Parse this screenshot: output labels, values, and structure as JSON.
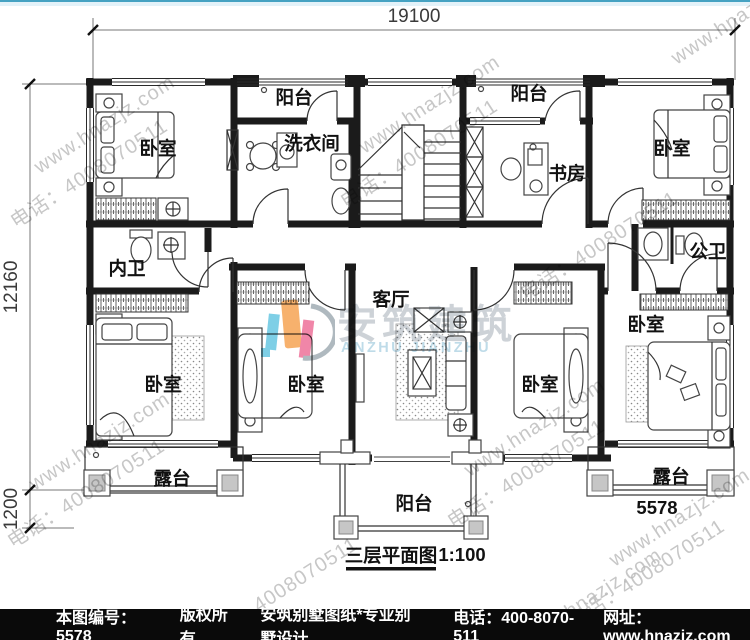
{
  "dimensions": {
    "width_total": "19100",
    "height_total": "12160",
    "terrace_offset": "1200"
  },
  "rooms": {
    "bedroom": "卧室",
    "balcony": "阳台",
    "laundry": "洗衣间",
    "study": "书房",
    "inner_bath": "内卫",
    "public_bath": "公卫",
    "living_room": "客厅",
    "terrace": "露台"
  },
  "plan": {
    "number": "5578",
    "title": "三层平面图",
    "scale": "1:100"
  },
  "watermark": {
    "site": "www.hnazjz.com",
    "phone": "电话：4008070511",
    "brand_cn": "安筑建筑",
    "brand_en": "ANZHU JIANZHU"
  },
  "footer": {
    "doc_no": "本图编号：5578",
    "copyright": "版权所有",
    "company": "安筑别墅图纸*专业别墅设计",
    "phone": "电话：400-8070-511",
    "website": "网址：www.hnazjz.com"
  }
}
